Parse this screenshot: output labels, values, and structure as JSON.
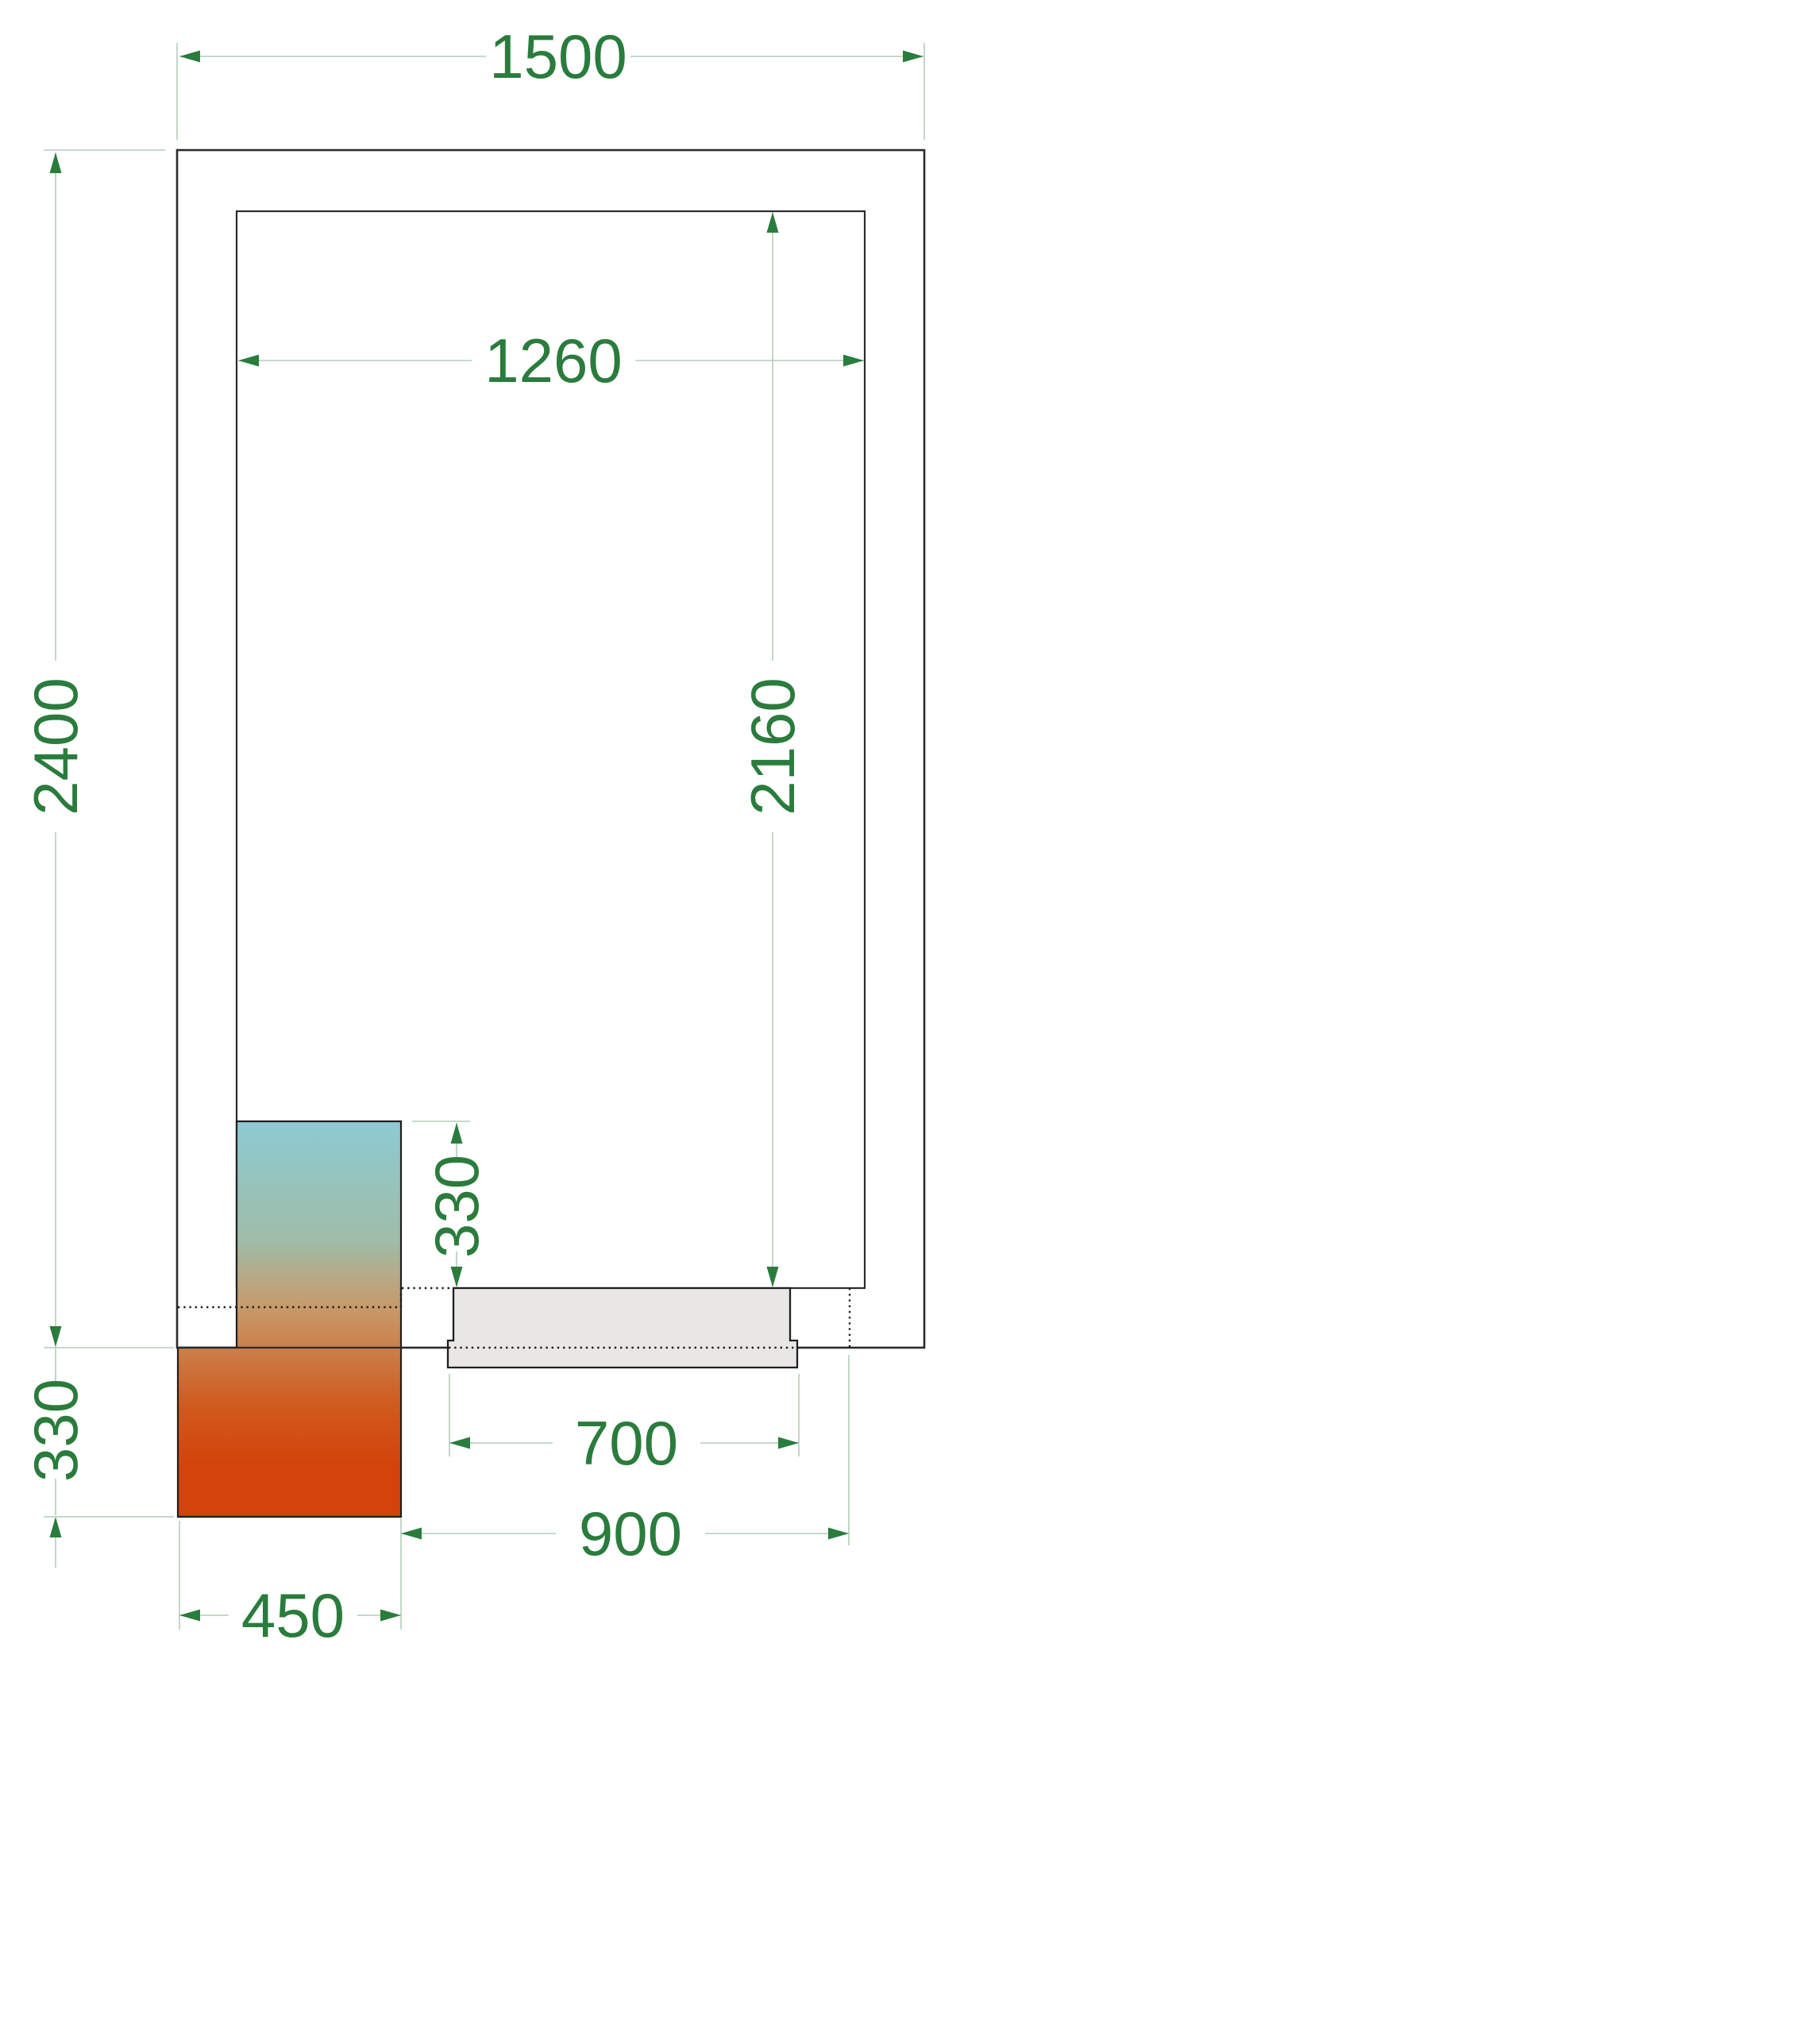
{
  "drawing": {
    "type": "cold-room-floor-plan-technical-drawing",
    "units": "mm",
    "dimensions": {
      "outer_width": "1500",
      "outer_depth": "2400",
      "inner_width": "1260",
      "inner_depth": "2160",
      "unit_to_door_offset": "330",
      "door_leaf_width": "700",
      "door_opening_width": "900",
      "unit_width": "450",
      "unit_outside_protrusion": "330"
    },
    "colors": {
      "wall_line": "#2b2b2b",
      "hidden_line": "#1f1f1f",
      "door_fill": "#e8e7e5",
      "dimension_line": "#b2cdbb",
      "dimension_text": "#2a7c3c",
      "unit_gradient_cold": "#8ccbd3",
      "unit_gradient_mid1": "#9fbca8",
      "unit_gradient_mid2": "#c79a6a",
      "unit_gradient_warm": "#d05a1d",
      "unit_gradient_hot": "#d3440c"
    }
  }
}
